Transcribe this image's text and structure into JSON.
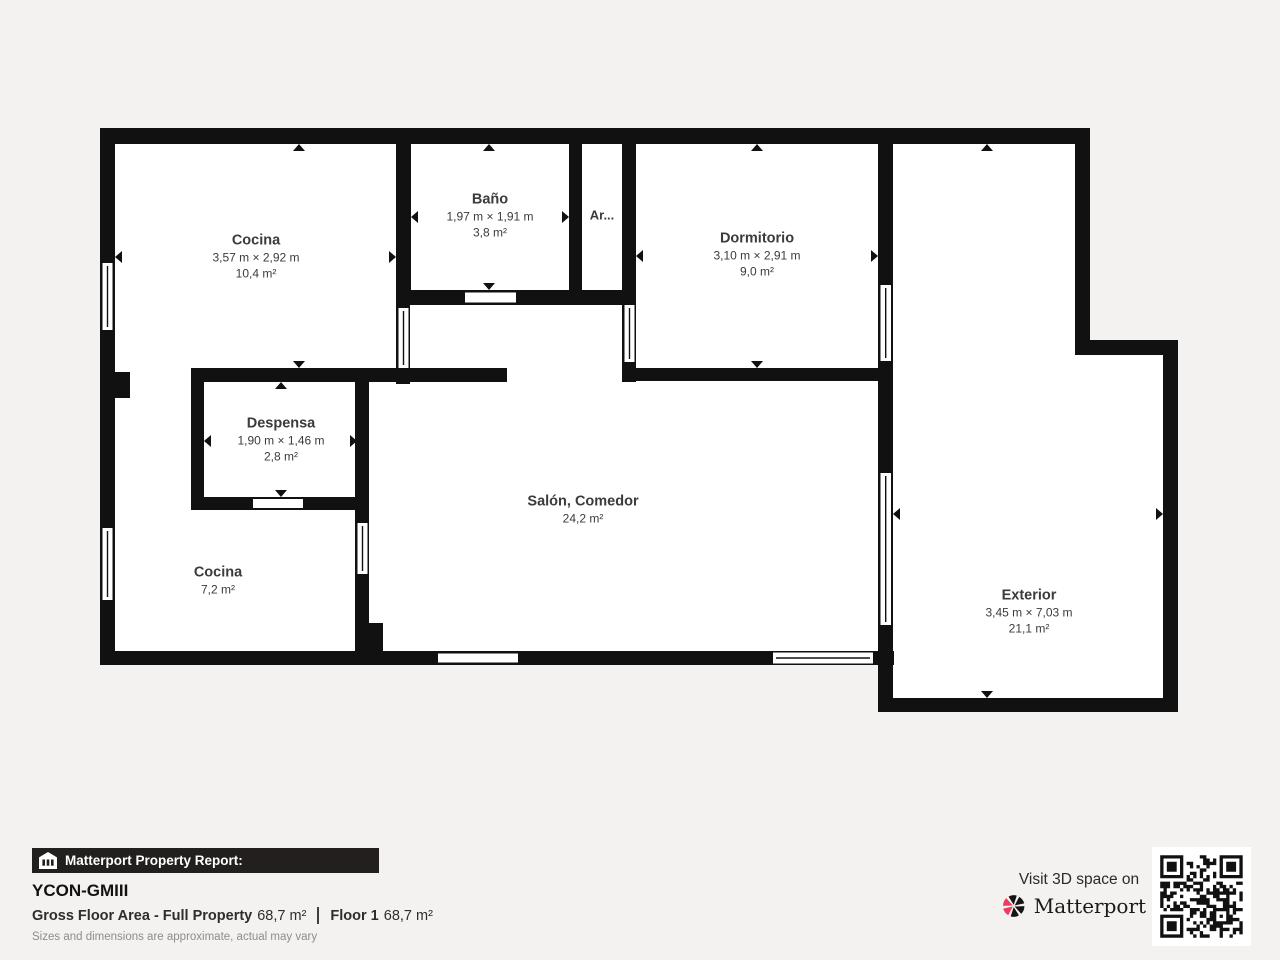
{
  "report": {
    "bar_label": "Matterport Property Report:",
    "property_name": "YCON-GMIII",
    "gross_label": "Gross Floor Area - Full Property",
    "gross_value": "68,7 m²",
    "floor_label": "Floor 1",
    "floor_value": "68,7 m²",
    "disclaimer": "Sizes and dimensions are approximate, actual may vary"
  },
  "visit": {
    "text": "Visit 3D space on",
    "brand": "Matterport"
  },
  "colors": {
    "background": "#f4f2f0",
    "wall": "#111111",
    "room_floor": "#ffffff",
    "label_text": "#3b3b3b",
    "bar_background": "#231f1e",
    "brand_pink": "#ee3b5e"
  },
  "icons": {
    "house_icon": "matterport-house-icon",
    "logo_icon": "matterport-pinwheel-icon",
    "qr": "qr-code"
  },
  "rooms": [
    {
      "name": "Cocina",
      "dims": "3,57 m × 2,92 m",
      "area": "10,4 m²"
    },
    {
      "name": "Baño",
      "dims": "1,97 m × 1,91 m",
      "area": "3,8 m²"
    },
    {
      "name": "Ar...",
      "dims": "",
      "area": ""
    },
    {
      "name": "Dormitorio",
      "dims": "3,10 m × 2,91 m",
      "area": "9,0 m²"
    },
    {
      "name": "Despensa",
      "dims": "1,90 m × 1,46 m",
      "area": "2,8 m²"
    },
    {
      "name": "Cocina",
      "dims": "",
      "area": "7,2 m²"
    },
    {
      "name": "Salón, Comedor",
      "dims": "",
      "area": "24,2 m²"
    },
    {
      "name": "Exterior",
      "dims": "3,45 m × 7,03 m",
      "area": "21,1 m²"
    }
  ]
}
